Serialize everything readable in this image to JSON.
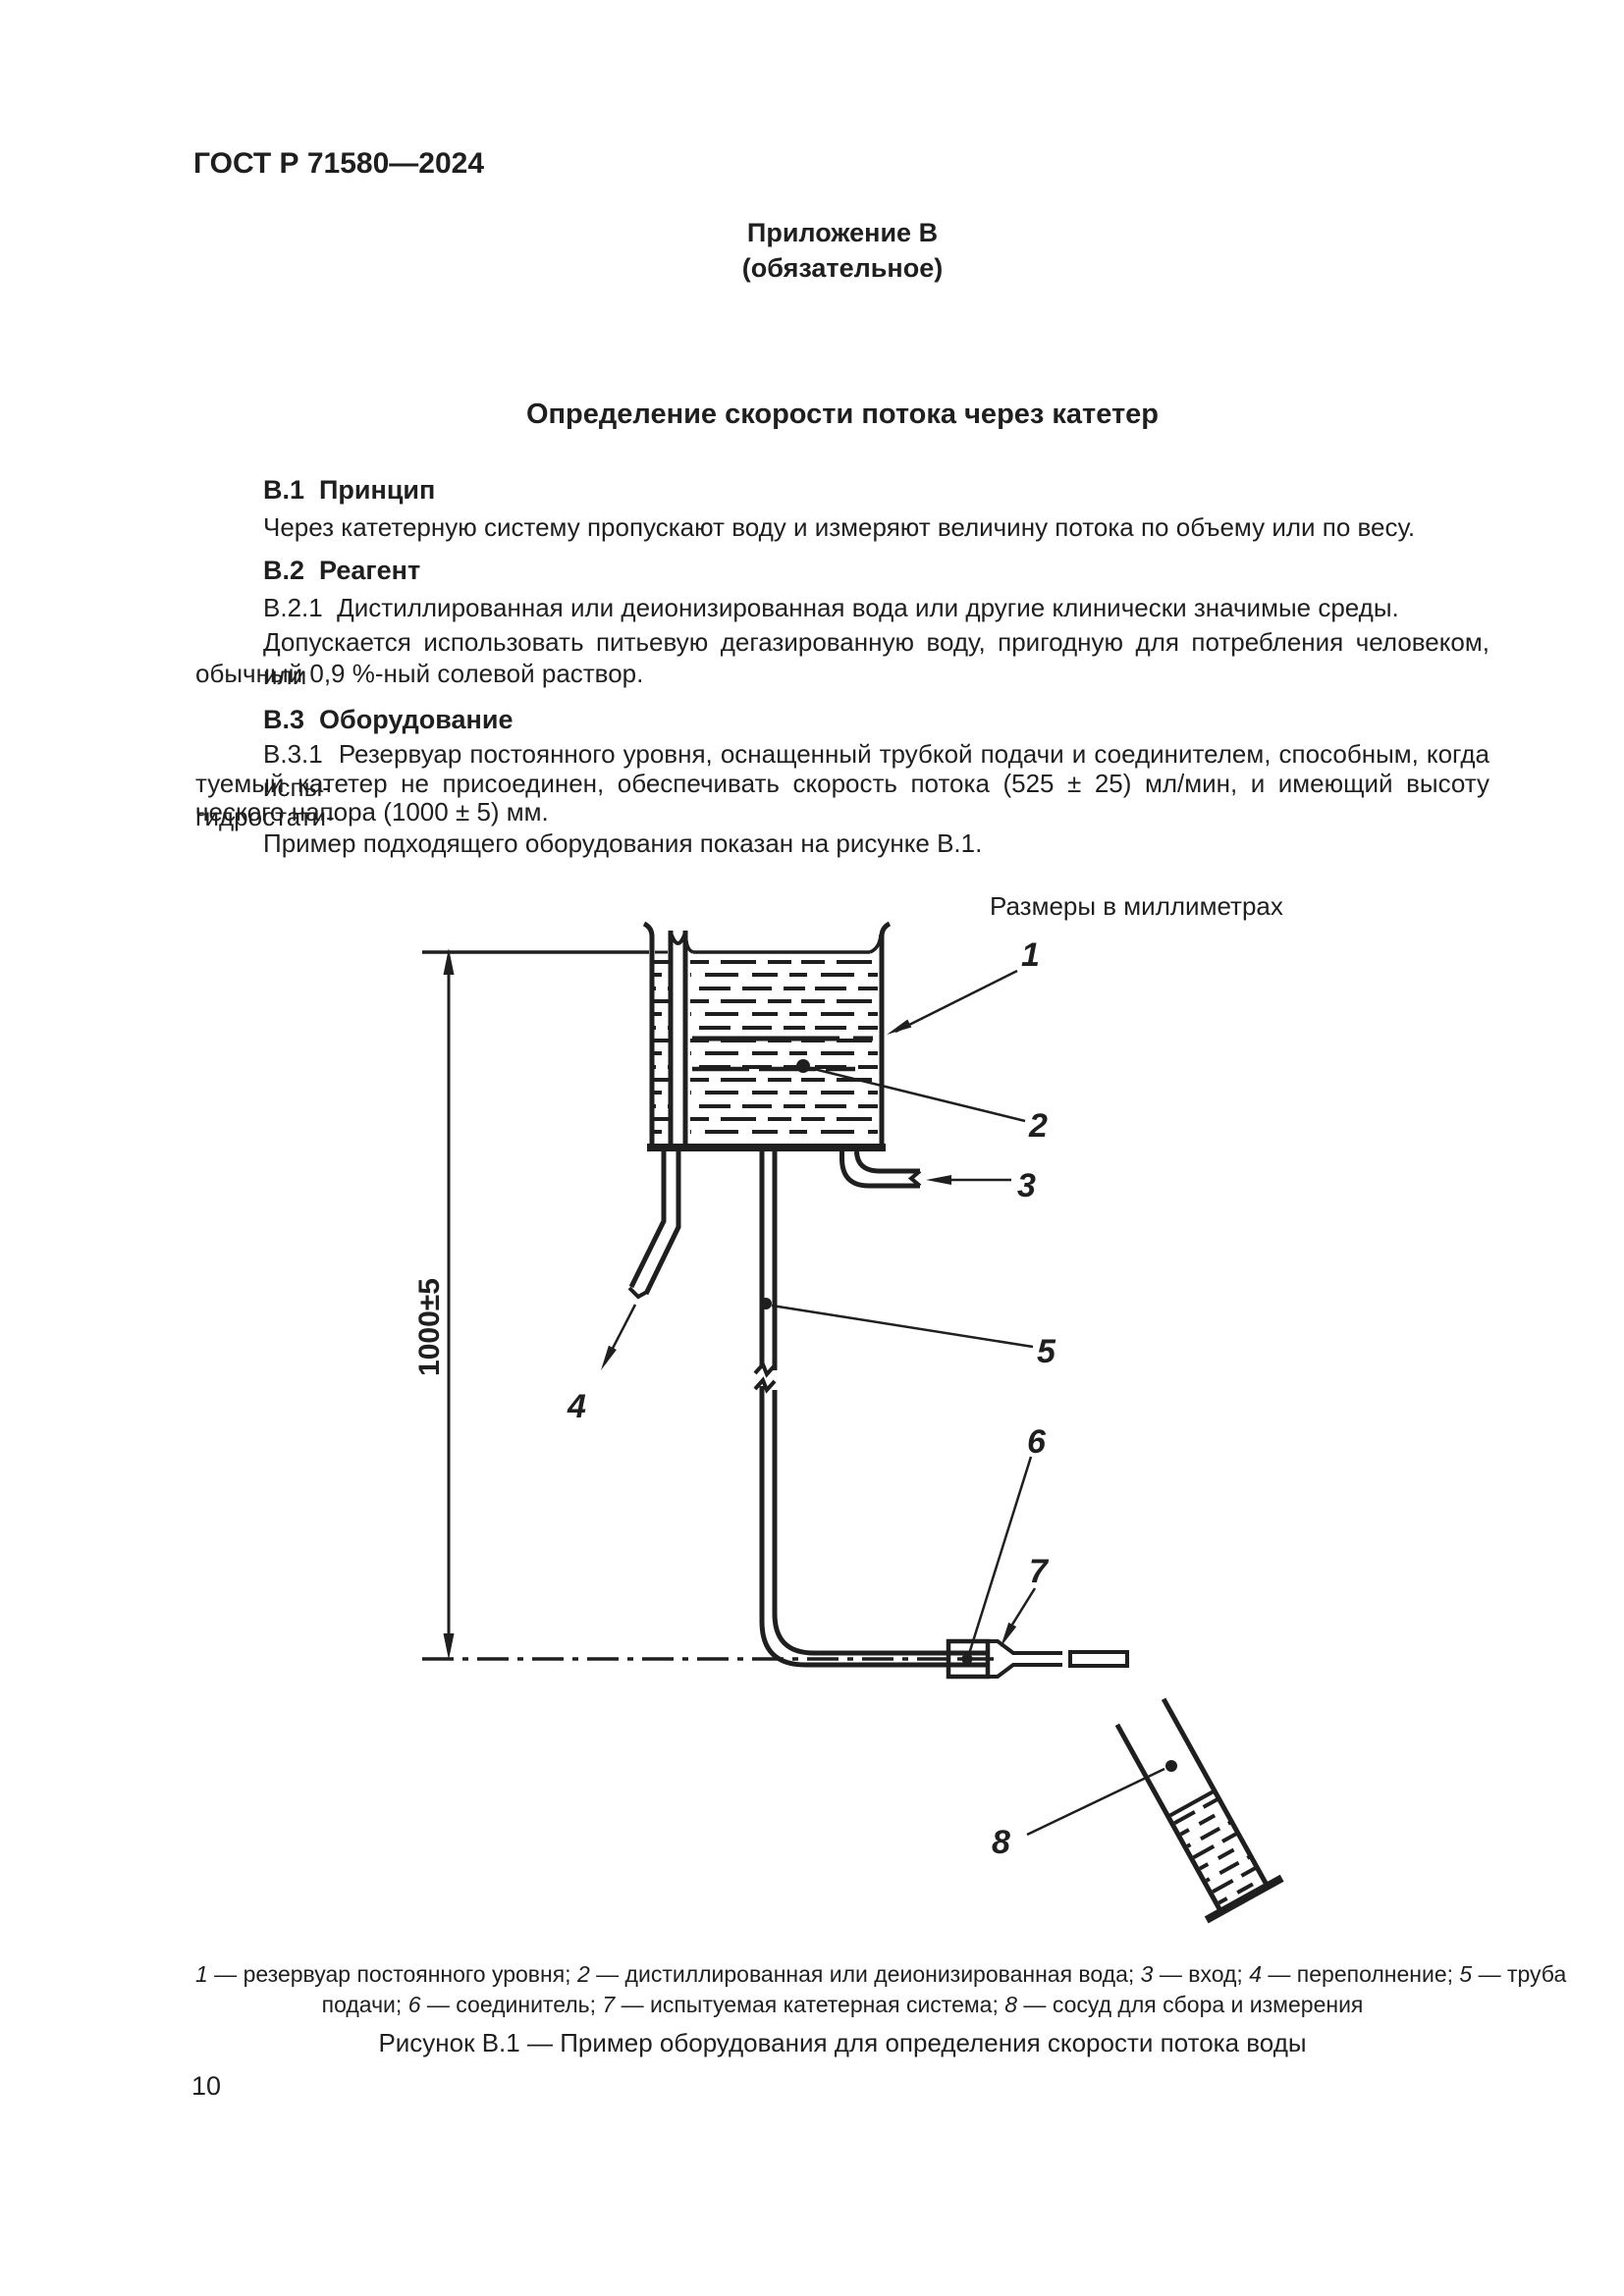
{
  "page": {
    "header": "ГОСТ Р 71580—2024",
    "number": "10"
  },
  "appendix": {
    "name": "Приложение В",
    "type": "(обязательное)",
    "title": "Определение скорости потока через катетер"
  },
  "s_b1": {
    "heading": "В.1  Принцип",
    "line1": "Через катетерную систему пропускают воду и измеряют величину потока по объему или по весу."
  },
  "s_b2": {
    "heading": "В.2  Реагент",
    "line1": "В.2.1  Дистиллированная или деионизированная вода или другие клинически значимые среды.",
    "line2": "Допускается использовать питьевую дегазированную воду, пригодную для потребления человеком, или",
    "line3": "обычный 0,9 %-ный солевой раствор."
  },
  "s_b3": {
    "heading": "В.3  Оборудование",
    "line1": "В.3.1  Резервуар постоянного уровня, оснащенный трубкой подачи и соединителем, способным, когда испы-",
    "line2": "туемый катетер не присоединен, обеспечивать скорость потока (525 ± 25) мл/мин, и имеющий высоту гидростати-",
    "line3": "ческого напора (1000 ± 5) мм.",
    "line4": "Пример подходящего оборудования показан на рисунке В.1."
  },
  "figure": {
    "units_note": "Размеры в миллиметрах",
    "dimension_label": "1000±5",
    "callouts": {
      "c1": "1",
      "c2": "2",
      "c3": "3",
      "c4": "4",
      "c5": "5",
      "c6": "6",
      "c7": "7",
      "c8": "8"
    },
    "legend_lines": [
      [
        {
          "n": "1"
        },
        {
          "t": " — резервуар постоянного уровня; "
        },
        {
          "n": "2"
        },
        {
          "t": " — дистиллированная или деионизированная вода; "
        },
        {
          "n": "3"
        },
        {
          "t": " — вход; "
        },
        {
          "n": "4"
        },
        {
          "t": " — переполнение; "
        },
        {
          "n": "5"
        },
        {
          "t": " — труба"
        }
      ],
      [
        {
          "t": "подачи; "
        },
        {
          "n": "6"
        },
        {
          "t": " — соединитель; "
        },
        {
          "n": "7"
        },
        {
          "t": " — испытуемая катетерная система; "
        },
        {
          "n": "8"
        },
        {
          "t": " — сосуд для сбора и измерения"
        }
      ]
    ],
    "caption": "Рисунок В.1 — Пример оборудования для определения скорости потока воды"
  },
  "colors": {
    "ink": "#1f1f1f",
    "paper": "#ffffff"
  }
}
